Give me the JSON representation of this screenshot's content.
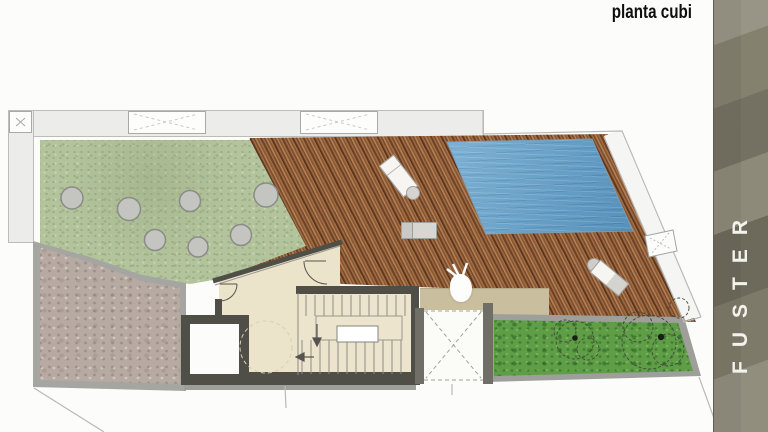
{
  "slide": {
    "title": "planta cubi",
    "brand": "FUSTER"
  },
  "palette": {
    "grass_terrace": "#b3c49d",
    "lawn_planter": "#5f9e47",
    "deck_wood": "#8a5634",
    "pool_water": "#5f9fca",
    "stone_terrace": "#b6aaa2",
    "interior_floor": "#ece4cb",
    "roof_band_tan": "#c9bf9e",
    "wall_dark": "#4f4e47",
    "sidebar_olive": "#85816f",
    "brand_text": "#f3f2ec"
  },
  "plan": {
    "type": "roof-terrace floor plan",
    "features": [
      {
        "name": "grass-terrace",
        "planter_circles": 7
      },
      {
        "name": "wood-deck",
        "lounge_chairs": 3,
        "side_tables": 2
      },
      {
        "name": "swimming-pool"
      },
      {
        "name": "stone-terrace"
      },
      {
        "name": "lawn-planter",
        "trees": 2
      },
      {
        "name": "stairwell"
      },
      {
        "name": "elevator-shaft"
      },
      {
        "name": "open-skylight-shaft"
      },
      {
        "name": "roof-skylights",
        "count": 3
      }
    ]
  }
}
